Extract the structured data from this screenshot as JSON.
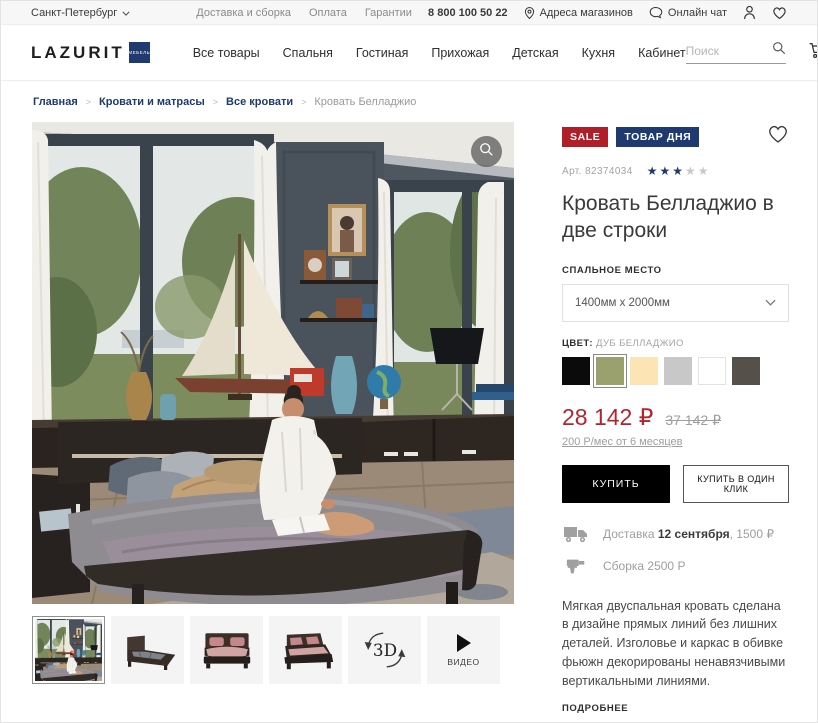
{
  "theme": {
    "navy": "#1e3a70",
    "red": "#b01e28",
    "price_red": "#b2252c",
    "star_empty": "#c9c9c9"
  },
  "icons": {
    "star": "★",
    "names": [
      "chevron-down-icon",
      "location-pin-icon",
      "chat-bubble-icon",
      "user-icon",
      "heart-icon",
      "search-icon",
      "cart-icon",
      "zoom-icon",
      "truck-icon",
      "drill-icon",
      "play-icon",
      "rotate-3d-icon"
    ]
  },
  "topbar": {
    "city": "Санкт-Петербург",
    "links": [
      "Доставка и сборка",
      "Оплата",
      "Гарантии"
    ],
    "phone": "8 800 100 50 22",
    "stores": "Адреса магазинов",
    "chat": "Онлайн чат"
  },
  "header": {
    "logo": "LAZURIT",
    "logo_sub": "МЕБЕЛЬ",
    "nav": [
      "Все товары",
      "Спальня",
      "Гостиная",
      "Прихожая",
      "Детская",
      "Кухня",
      "Кабинет"
    ],
    "search_placeholder": "Поиск",
    "cart_count": "24"
  },
  "breadcrumb": {
    "separator": ">",
    "items": [
      "Главная",
      "Кровати и матрасы",
      "Все кровати",
      "Кровать Белладжио"
    ]
  },
  "product": {
    "badge_sale": "SALE",
    "badge_deal": "ТОВАР ДНЯ",
    "sku": "Арт. 82374034",
    "rating": {
      "filled": 3,
      "total": 5
    },
    "title": "Кровать Белладжио в две строки",
    "size_label": "СПАЛЬНОЕ МЕСТО",
    "size_value": "1400мм x 2000мм",
    "color_label": "ЦВЕТ:",
    "color_name": "ДУБ БЕЛЛАДЖИО",
    "swatches": [
      "#0b0b0b",
      "#9aa06e",
      "#fce4b5",
      "#c8c8c8",
      "#ffffff",
      "#55504a"
    ],
    "selected_swatch": 1,
    "price": "28 142 ₽",
    "old_price": "37 142 ₽",
    "installment": "200 Р/мес от 6 месяцев",
    "buy_label": "КУПИТЬ",
    "one_click_label": "КУПИТЬ В ОДИН КЛИК",
    "delivery_prefix": "Доставка ",
    "delivery_date": "12 сентября",
    "delivery_suffix": ", 1500 ₽",
    "assembly": "Сборка 2500 Р",
    "description": "Мягкая двуспальная кровать сделана в дизайне прямых линий без лишних деталей. Изголовье и каркас в обивке фьюжн декорированы ненавязчивыми вертикальными линиями.",
    "more_label": "ПОДРОБНЕЕ"
  },
  "gallery": {
    "three_d_label": "3D",
    "video_label": "ВИДЕО"
  }
}
